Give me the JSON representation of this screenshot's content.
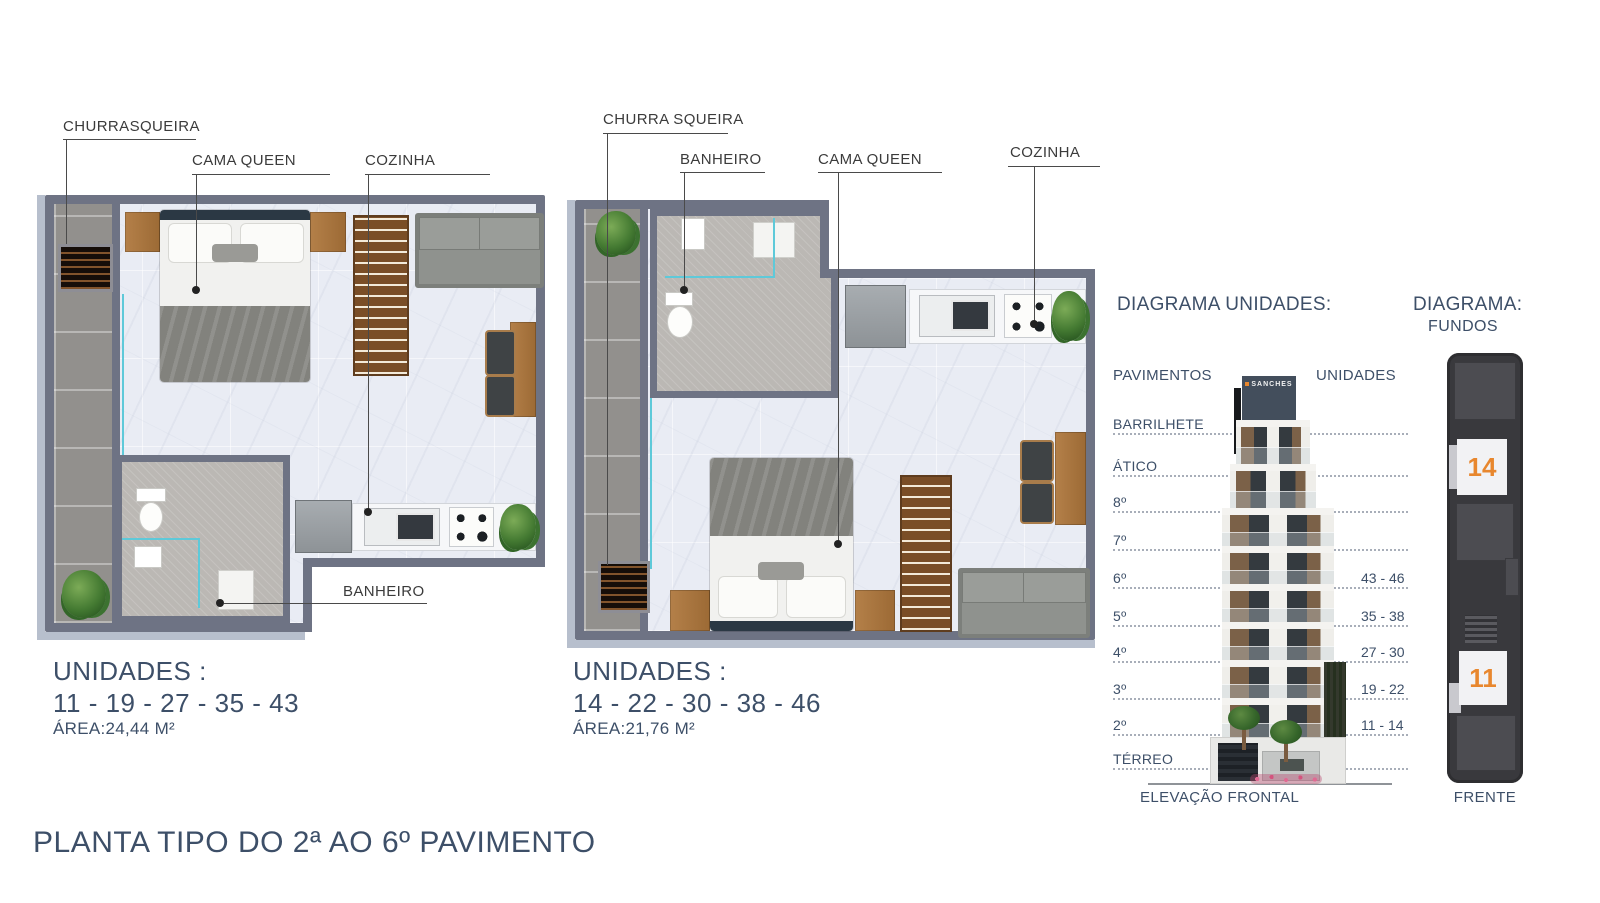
{
  "plan1": {
    "labels": {
      "churrasqueira": "CHURRASQUEIRA",
      "cama_queen": "CAMA QUEEN",
      "cozinha": "COZINHA",
      "banheiro": "BANHEIRO"
    },
    "units_title": "UNIDADES :",
    "units": "11 - 19 - 27 - 35 - 43",
    "area": "ÁREA:24,44 M²"
  },
  "plan2": {
    "labels": {
      "churrasqueira": "CHURRA SQUEIRA",
      "banheiro": "BANHEIRO",
      "cama_queen": "CAMA QUEEN",
      "cozinha": "COZINHA"
    },
    "units_title": "UNIDADES :",
    "units": "14 - 22 - 30 - 38 - 46",
    "area": "ÁREA:21,76 M²"
  },
  "diagram": {
    "title": "DIAGRAMA UNIDADES:",
    "col_pavimentos": "PAVIMENTOS",
    "col_unidades": "UNIDADES",
    "sign": "SANCHES",
    "floors": [
      {
        "label": "BARRILHETE",
        "units": ""
      },
      {
        "label": "ÁTICO",
        "units": ""
      },
      {
        "label": "8º",
        "units": ""
      },
      {
        "label": "7º",
        "units": ""
      },
      {
        "label": "6º",
        "units": "43 - 46"
      },
      {
        "label": "5º",
        "units": "35 - 38"
      },
      {
        "label": "4º",
        "units": "27 - 30"
      },
      {
        "label": "3º",
        "units": "19 - 22"
      },
      {
        "label": "2º",
        "units": "11 - 14"
      },
      {
        "label": "TÉRREO",
        "units": ""
      }
    ],
    "caption": "ELEVAÇÃO FRONTAL"
  },
  "key_plan": {
    "title": "DIAGRAMA:",
    "subtitle": "FUNDOS",
    "unit_top": "14",
    "unit_bottom": "11",
    "caption": "FRENTE"
  },
  "footer": {
    "title": "PLANTA TIPO DO 2ª AO 6º PAVIMENTO"
  },
  "colors": {
    "accent_text": "#3d4f68",
    "label_text": "#3b3b3b",
    "wall": "#6e7384",
    "unit_highlight": "#e8872e"
  }
}
